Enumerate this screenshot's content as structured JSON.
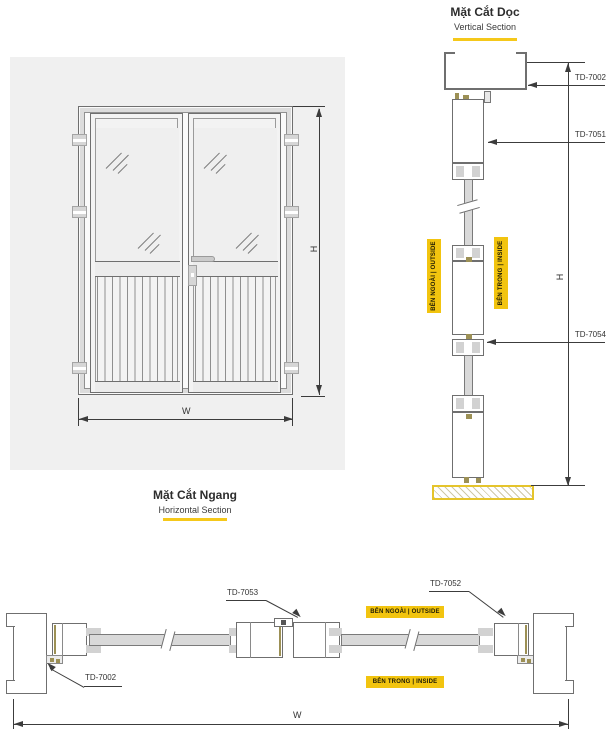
{
  "colors": {
    "accent_yellow": "#F2C40F",
    "underline_yellow": "#F5C81A",
    "floor_yellow": "#E5C42B",
    "drawing_line": "#6F6F6F",
    "dimension_line": "#3C3C3C",
    "panel_bg": "#F0F0F0",
    "gasket_olive": "#9C9055"
  },
  "elevation": {
    "dim_height": "H",
    "dim_width": "W"
  },
  "vertical_section": {
    "title": "Mặt Cắt Dọc",
    "subtitle": "Vertical Section",
    "outside_label": "BÊN NGOÀI | OUTSIDE",
    "inside_label": "BÊN TRONG | INSIDE",
    "dim_height": "H",
    "callouts": {
      "head_frame": "TD-7002",
      "door_top_rail": "TD-7051",
      "door_mid_rail": "TD-7054"
    }
  },
  "horizontal_section": {
    "title": "Mặt Cắt Ngang",
    "subtitle": "Horizontal Section",
    "outside_label": "BÊN NGOÀI | OUTSIDE",
    "inside_label": "BÊN TRONG | INSIDE",
    "dim_width": "W",
    "callouts": {
      "frame_jamb": "TD-7002",
      "meeting_stile": "TD-7053",
      "hinge_stile": "TD-7052"
    }
  }
}
